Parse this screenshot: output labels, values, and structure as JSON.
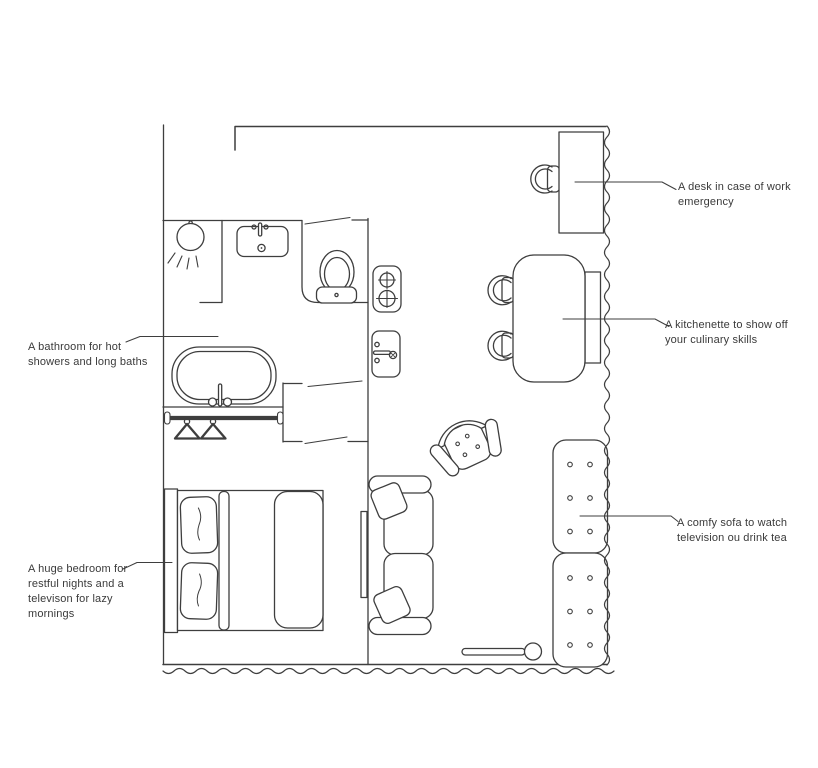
{
  "page": {
    "background_color": "#ffffff",
    "line_color": "#3e3e3e",
    "text_color": "#3a3a3a"
  },
  "annotations": {
    "desk": "A desk in case of work\nemergency",
    "kitchenette": "A kitchenette to show off\nyour culinary skills",
    "sofa": "A comfy sofa to watch\ntelevision ou drink tea",
    "bathroom": "A bathroom for hot\nshowers and long baths",
    "bedroom": "A huge bedroom for\nrestful nights and a\ntelevison for lazy\nmornings"
  },
  "floorplan": {
    "rooms": [
      "bathroom",
      "bedroom",
      "kitchenette",
      "living-area"
    ],
    "furniture_icons": [
      "shower-icon",
      "washbasin-icon",
      "toilet-icon",
      "stove-icon",
      "kitchen-sink-icon",
      "bathtub-icon",
      "clothes-rail-icon",
      "hanger-icon",
      "double-bed-icon",
      "pillow-icon",
      "television-icon",
      "sofa-icon",
      "armchair-icon",
      "dining-table-icon",
      "dining-chair-icon",
      "counter-icon",
      "desk-icon",
      "desk-chair-icon",
      "tufted-bench-icon",
      "floor-lamp-icon"
    ]
  }
}
